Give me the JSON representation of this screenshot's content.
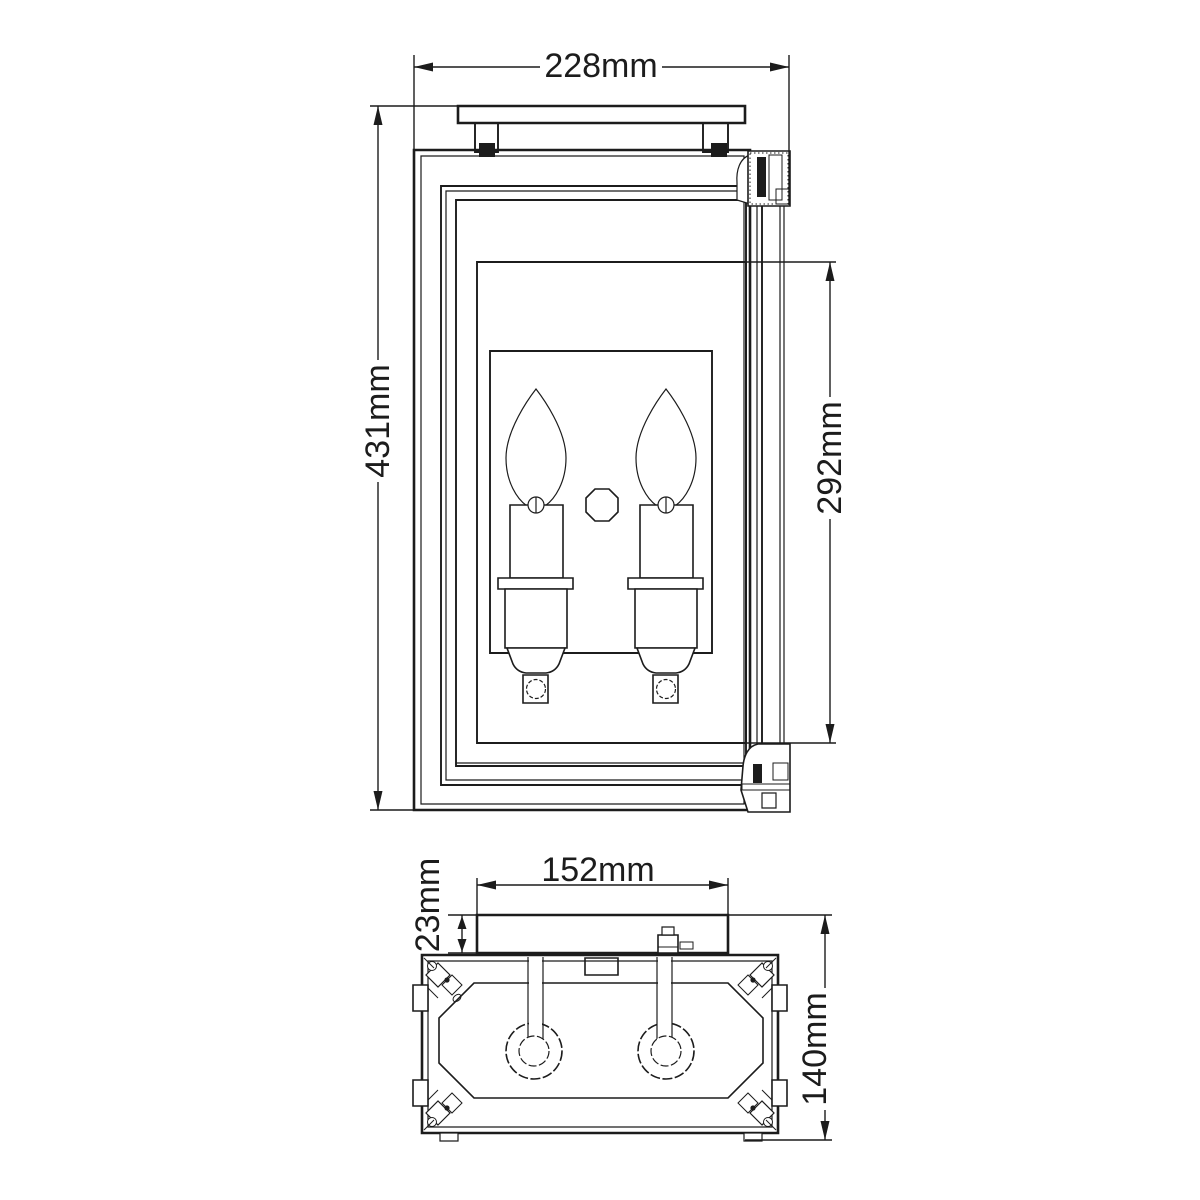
{
  "drawing": {
    "background": "#ffffff",
    "line_color": "#1c1c1c",
    "views": {
      "front": {
        "name": "front-elevation",
        "dimensions": {
          "overall_width": "228mm",
          "overall_height": "431mm",
          "glass_panel_height": "292mm"
        }
      },
      "top": {
        "name": "top-plan",
        "dimensions": {
          "backplate_width": "152mm",
          "backplate_depth": "23mm",
          "overall_depth": "140mm"
        }
      }
    }
  }
}
